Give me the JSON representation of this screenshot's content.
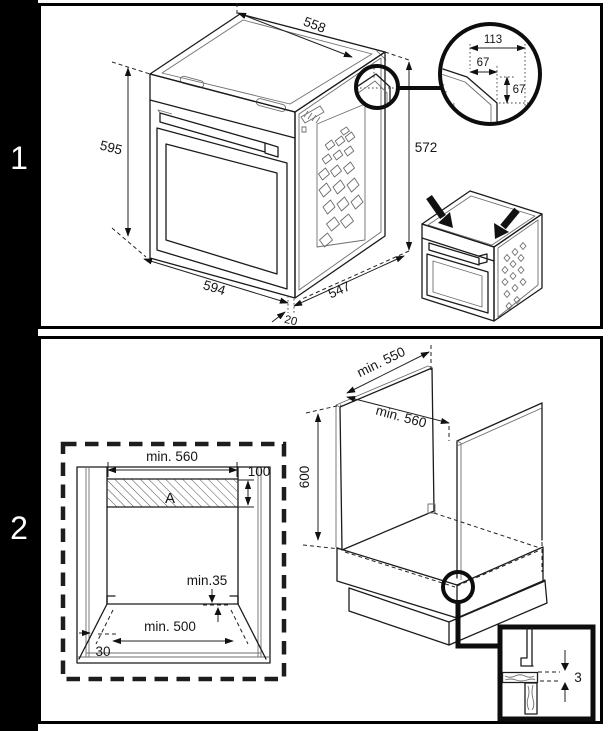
{
  "panel1": {
    "step_label": "1",
    "oven_dims": {
      "top_width": "558",
      "front_height": "595",
      "rear_height": "572",
      "bottom_width": "594",
      "depth": "547",
      "door_offset": "20"
    },
    "corner_detail": {
      "total_width": "113",
      "inner_width": "67",
      "inner_height": "67"
    }
  },
  "panel2": {
    "step_label": "2",
    "niche_front": {
      "top_width": "min. 560",
      "vent_height": "100",
      "vent_area_label": "A",
      "rear_clearance": "min.35",
      "bottom_width": "min. 500",
      "side_clearance": "30"
    },
    "cabinet": {
      "depth": "min. 550",
      "width": "min. 560",
      "height": "600"
    },
    "gap_detail": {
      "gap": "3"
    }
  }
}
